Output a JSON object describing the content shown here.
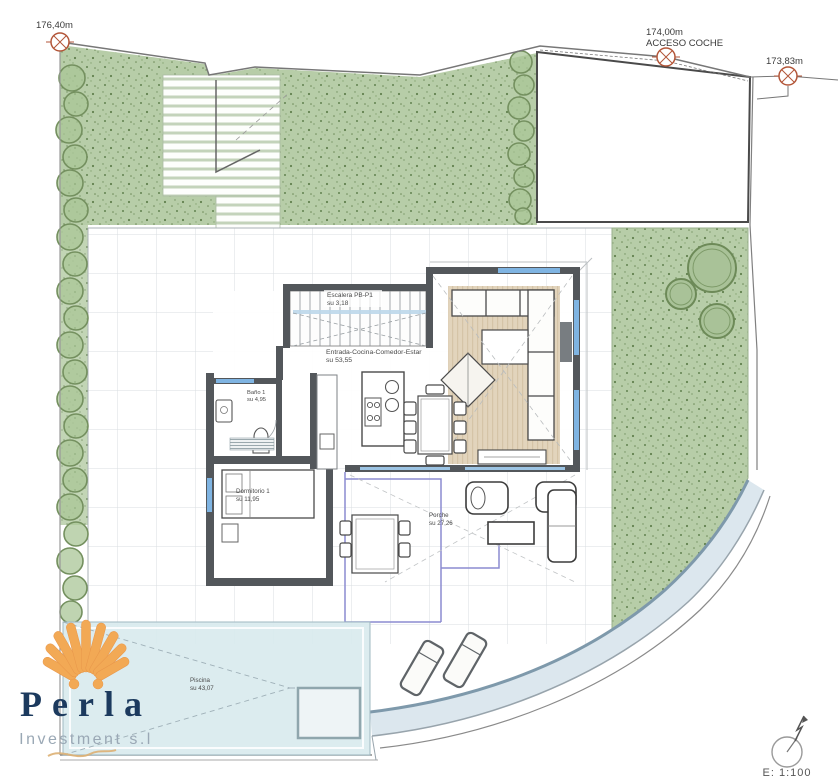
{
  "plan_title": "Villa ground floor site plan",
  "markers": {
    "m1": {
      "label": "176,40m"
    },
    "m2": {
      "line1": "174,00m",
      "line2": "ACCESO COCHE"
    },
    "m3": {
      "label": "173,83m"
    }
  },
  "rooms": {
    "escalera": {
      "name": "Escalera PB-P1",
      "area": "su 3,18"
    },
    "salon": {
      "name": "Entrada-Cocina-Comedor-Estar",
      "area": "su 53,55"
    },
    "bano": {
      "name": "Baño 1",
      "area": "su 4,95"
    },
    "dormitorio": {
      "name": "Dormitorio 1",
      "area": "su 11,95"
    },
    "porche": {
      "name": "Porche",
      "area": "su 27,26"
    },
    "piscina": {
      "name": "Piscina",
      "area": "su 43,07"
    }
  },
  "titleblock": {
    "scale": "E: 1:100"
  },
  "logo": {
    "brand": "Perla",
    "subtitle": "Investment s.l"
  },
  "colors": {
    "garden_green": "#b7cda8",
    "pool_blue": "#d9eaee",
    "wall_gray": "#53575b",
    "marker_red": "#b35639",
    "logo_navy": "#1c3a5e",
    "logo_orange": "#f2a955",
    "porch_purple": "#8b8bd0"
  }
}
